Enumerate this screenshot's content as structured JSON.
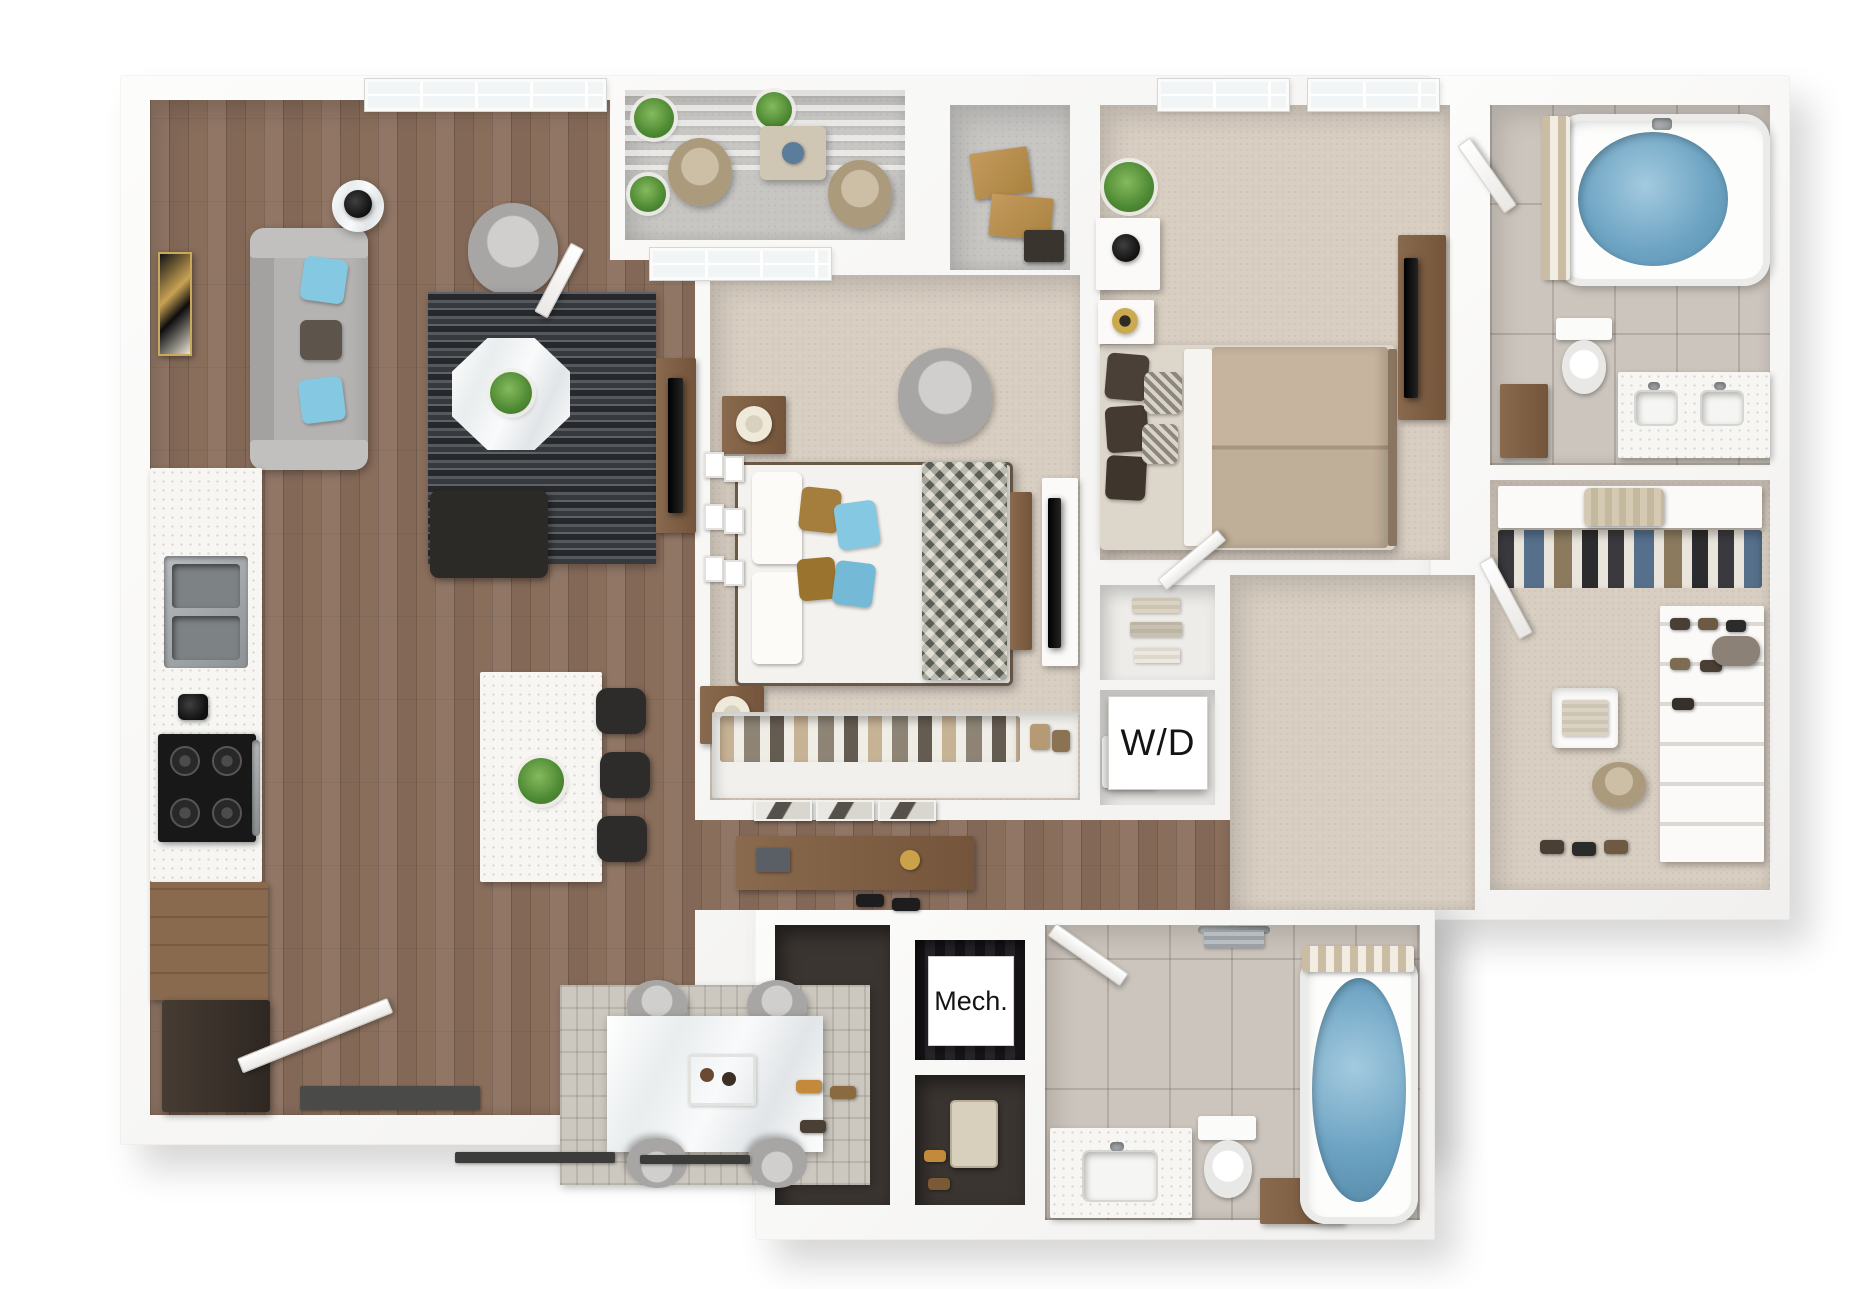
{
  "floorplan": {
    "labels": {
      "washer_dryer": "W/D",
      "mechanical": "Mech."
    },
    "colors": {
      "wall": "#f1f0ee",
      "wood": "#8a6e5c",
      "carpet": "#d8cec2",
      "tile": "#ccc5bd",
      "concrete": "#c7c6c3",
      "water_blue": "#6fa5c4",
      "pillow_blue": "#84c8e2",
      "sofa_gray": "#b4b3b1",
      "cabinet_wood": "#8a6a4e",
      "rug_beige": "#ccc8bf",
      "plant_green": "#4e8a33"
    }
  }
}
